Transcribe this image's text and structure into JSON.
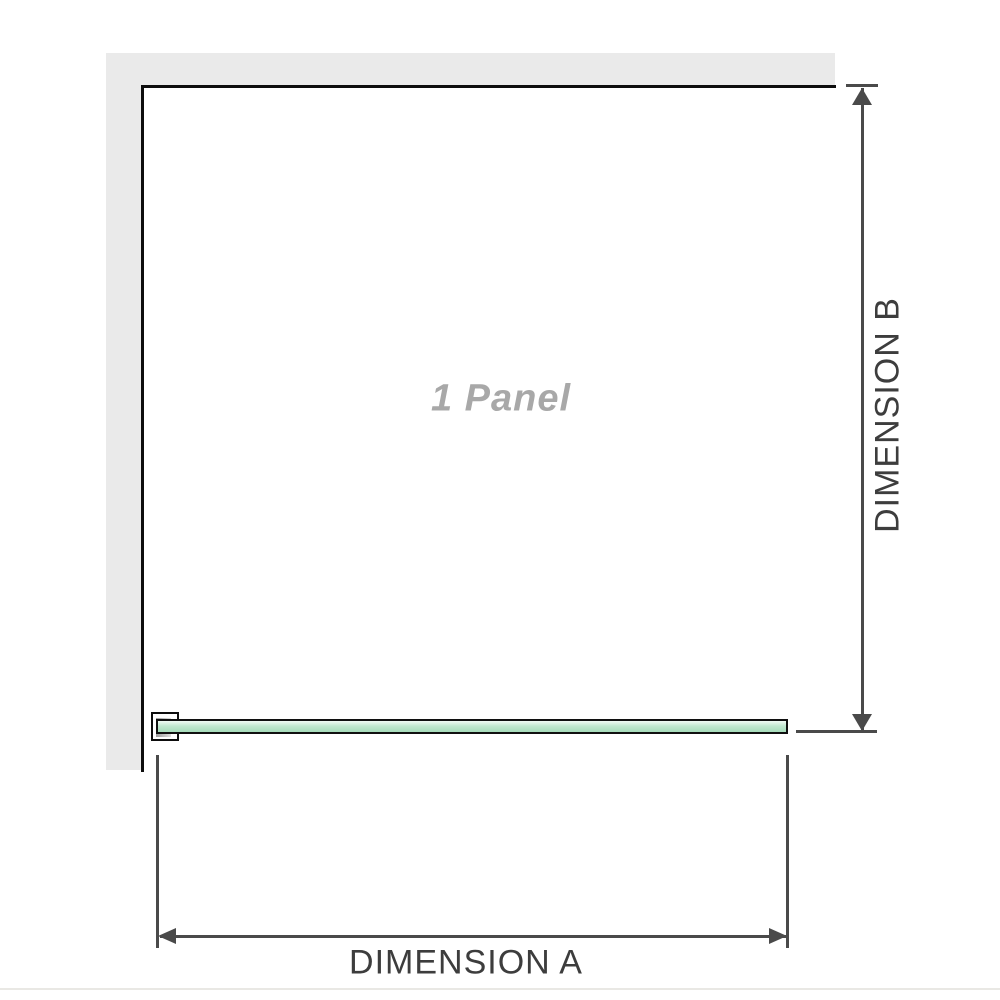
{
  "labels": {
    "panel": "1 Panel",
    "dimension_a": "DIMENSION A",
    "dimension_b": "DIMENSION B"
  },
  "colors": {
    "background": "#ffffff",
    "wall_fill": "#eaeaea",
    "edge": "#0d0d0d",
    "dim": "#4a4a4a",
    "label": "#3d3d3d",
    "panel_label": "#a8a8a8",
    "glass_border": "#101010",
    "glass_top": "#f2fbf5",
    "glass_mid": "#c2e8d0",
    "glass_low": "#a6dcba",
    "bracket_inner_dark": "#9c9c9c",
    "bracket_inner_light": "#dedede",
    "baseline": "#e9e8e4"
  }
}
